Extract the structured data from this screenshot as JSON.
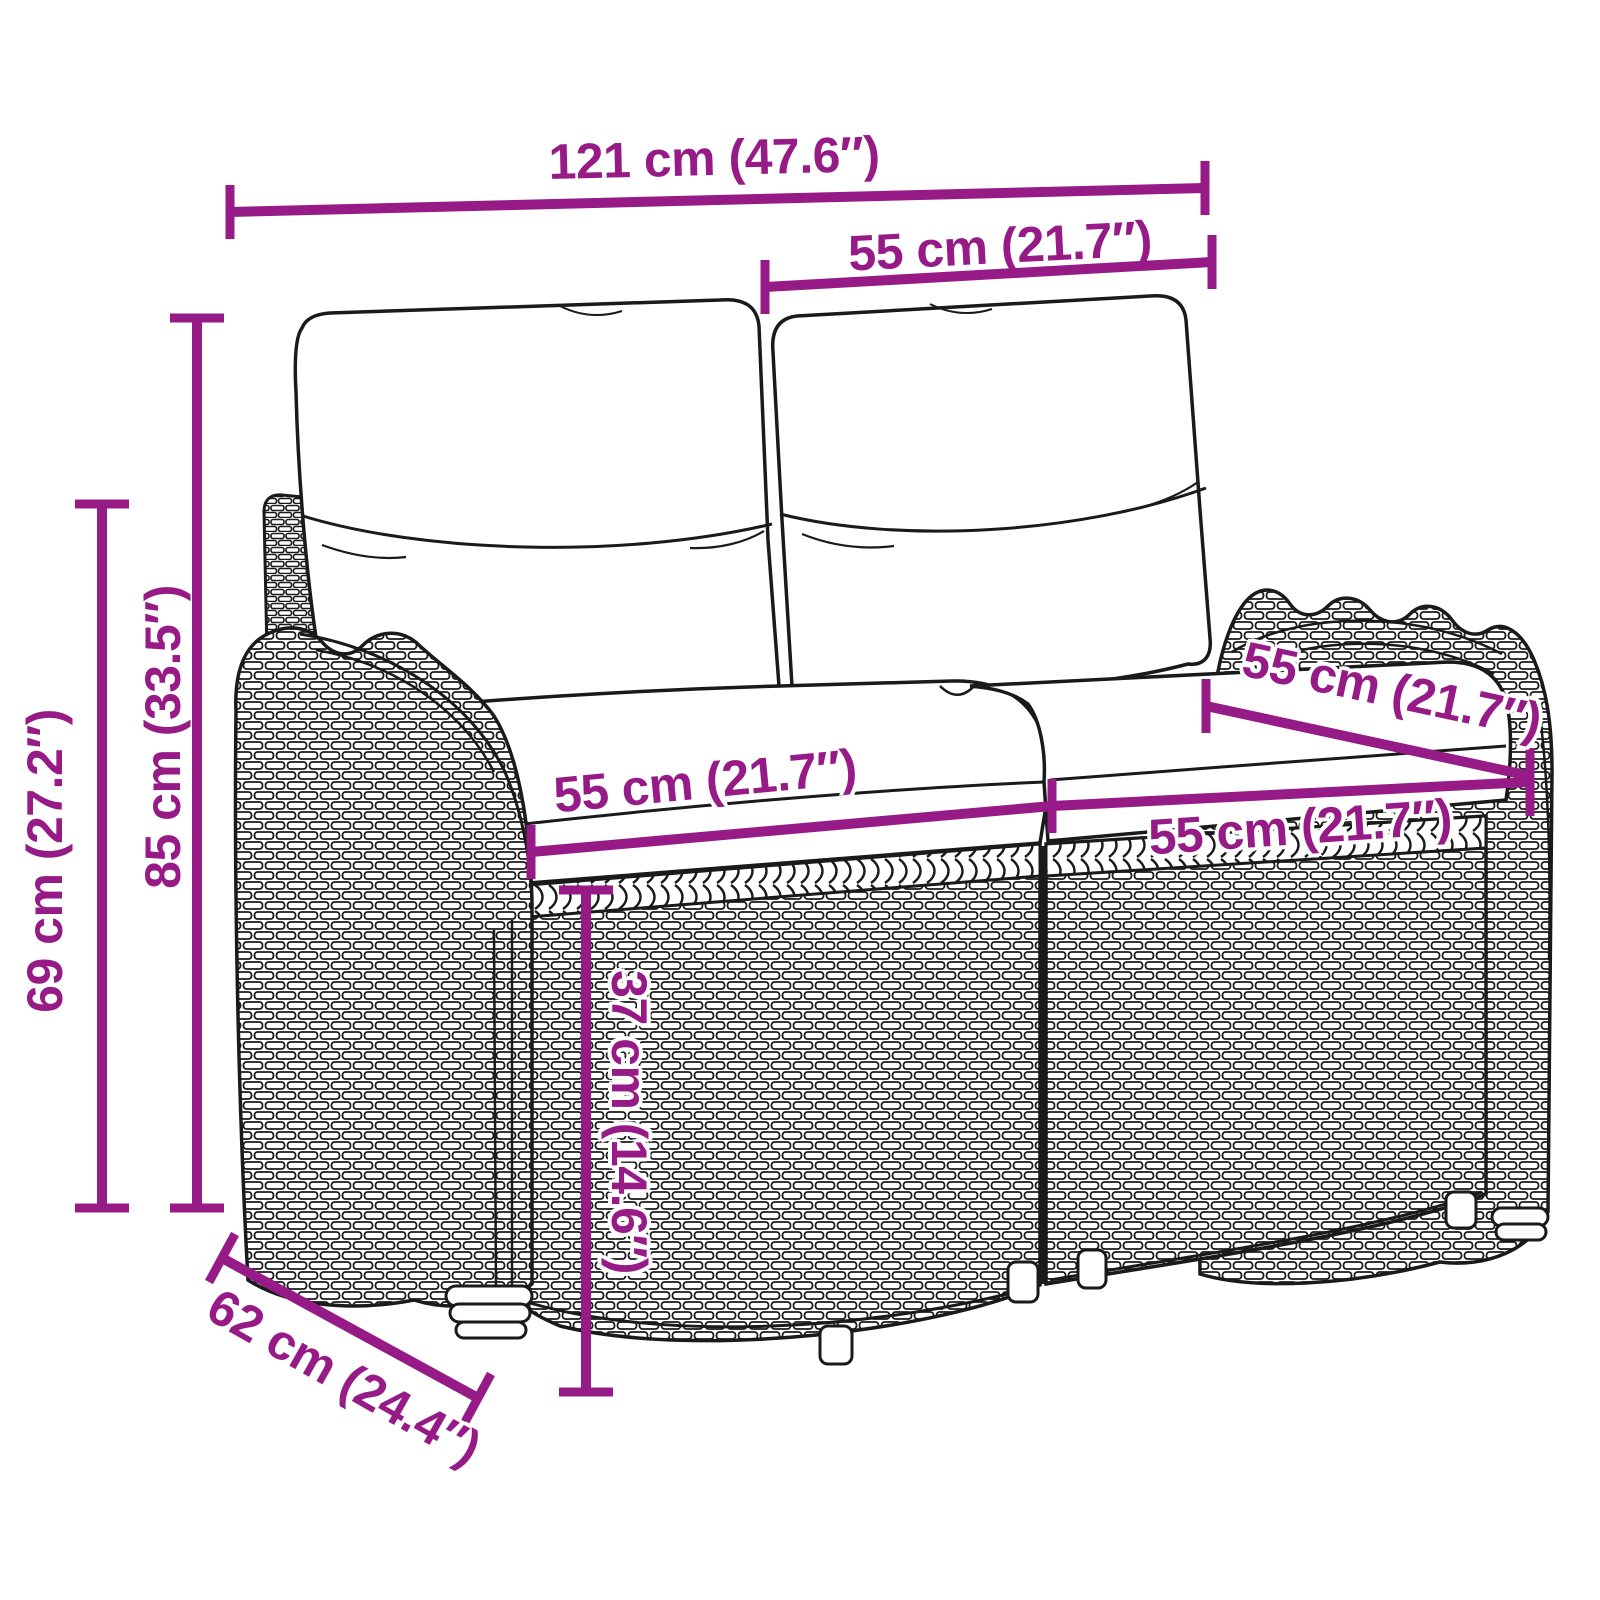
{
  "figure": {
    "type": "product-dimension-diagram",
    "subject": "poly rattan 2-seater garden bench with back and seat cushions",
    "style": "black line-art drawing with magenta dimension lines"
  },
  "colors": {
    "dimension_accent": "#961B87",
    "line_art": "#1a1a1a",
    "background": "#ffffff"
  },
  "units": {
    "primary": "cm",
    "secondary": "in"
  },
  "dimensions": {
    "overall_width": {
      "label": "121 cm (47.6″)",
      "cm": 121,
      "inches": 47.6
    },
    "backrest_width": {
      "label": "55 cm (21.7″)",
      "cm": 55,
      "inches": 21.7
    },
    "total_height": {
      "label": "85 cm (33.5″)",
      "cm": 85,
      "inches": 33.5
    },
    "armrest_height": {
      "label": "69 cm (27.2″)",
      "cm": 69,
      "inches": 27.2
    },
    "seat_width_left": {
      "label": "55 cm (21.7″)",
      "cm": 55,
      "inches": 21.7
    },
    "seat_width_right": {
      "label": "55 cm (21.7″)",
      "cm": 55,
      "inches": 21.7
    },
    "seat_depth": {
      "label": "55 cm (21.7″)",
      "cm": 55,
      "inches": 21.7
    },
    "seat_height": {
      "label": "37 cm (14.6″)",
      "cm": 37,
      "inches": 14.6
    },
    "overall_depth": {
      "label": "62 cm (24.4″)",
      "cm": 62,
      "inches": 24.4
    }
  }
}
